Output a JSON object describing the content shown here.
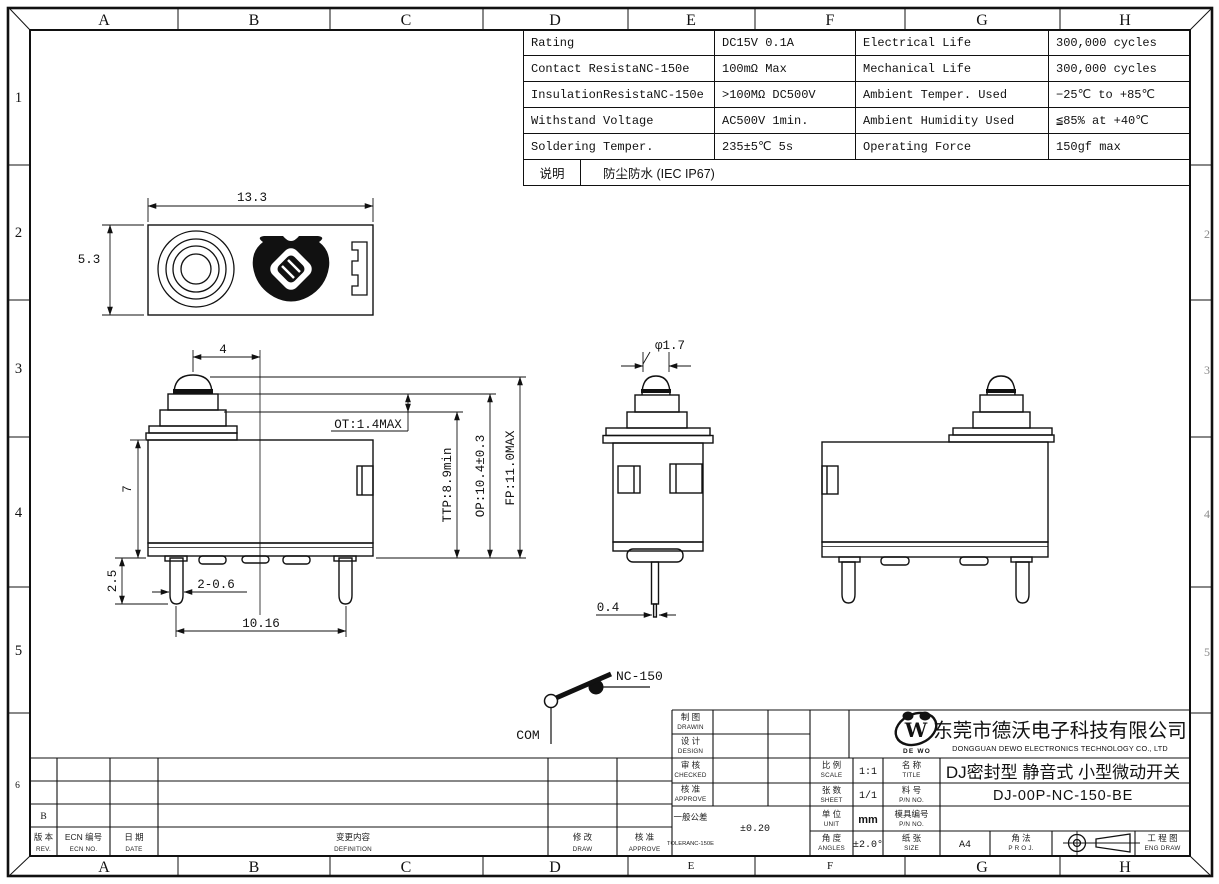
{
  "frame": {
    "cols": [
      "A",
      "B",
      "C",
      "D",
      "E",
      "F",
      "G",
      "H"
    ],
    "rows": [
      "1",
      "2",
      "3",
      "4",
      "5",
      "6"
    ],
    "rows_right": [
      "2",
      "3",
      "4",
      "5"
    ]
  },
  "spec": {
    "rows": [
      [
        "Rating",
        "DC15V 0.1A",
        "Electrical Life",
        "300,000 cycles"
      ],
      [
        "Contact ResistaNC-150e",
        "100mΩ Max",
        "Mechanical Life",
        "300,000 cycles"
      ],
      [
        "InsulationResistaNC-150e",
        ">100MΩ DC500V",
        "Ambient Temper. Used",
        "−25℃ to +85℃"
      ],
      [
        "Withstand Voltage",
        "AC500V 1min.",
        "Ambient Humidity Used",
        "≦85% at +40℃"
      ],
      [
        "Soldering Temper.",
        "235±5℃ 5s",
        "Operating Force",
        "150gf max"
      ]
    ],
    "note_label": "说明",
    "note_value": "防尘防水 (IEC IP67)"
  },
  "dims": {
    "width": "13.3",
    "height": "5.3",
    "offset": "4",
    "ot": "OT:1.4MAX",
    "ttp": "TTP:8.9min",
    "op": "OP:10.4±0.3",
    "fp": "FP:11.0MAX",
    "body": "7",
    "pin_len": "2.5",
    "pin_w": "2-0.6",
    "pitch": "10.16",
    "dia": "φ1.7",
    "tip": "0.4"
  },
  "circuit": {
    "nc": "NC-150",
    "com": "COM"
  },
  "revisions": {
    "rev_zh": "版 本",
    "rev_en": "REV.",
    "ecn_zh": "ECN 编号",
    "ecn_en": "ECN NO.",
    "date_zh": "日 期",
    "date_en": "DATE",
    "def_zh": "变更内容",
    "def_en": "DEFINITION",
    "draw_zh": "修 改",
    "draw_en": "DRAW",
    "appr_zh": "核 准",
    "appr_en": "APPROVE",
    "entry_rev": "B"
  },
  "tb": {
    "drawin_zh": "制 图",
    "drawin_en": "DRAWIN",
    "design_zh": "设 计",
    "design_en": "DESIGN",
    "checked_zh": "审 核",
    "checked_en": "CHECKED",
    "approve_zh": "核 准",
    "approve_en": "APPROVE",
    "tol_zh": "一般公差",
    "tol_en": "TOLERANC-150E",
    "tol_val": "±0.20",
    "scale_zh": "比 例",
    "scale_en": "SCALE",
    "scale_val": "1:1",
    "sheet_zh": "张 数",
    "sheet_en": "SHEET",
    "sheet_val": "1/1",
    "unit_zh": "单 位",
    "unit_en": "UNIT",
    "unit_val": "mm",
    "angles_zh": "角 度",
    "angles_en": "ANGLES",
    "angles_val": "±2.0°",
    "title_zh": "名 称",
    "title_en": "TITLE",
    "title_val": "DJ密封型 静音式 小型微动开关",
    "pn_zh": "料 号",
    "pn_en": "P/N NO.",
    "pn_val": "DJ-00P-NC-150-BE",
    "mold_zh": "模具编号",
    "mold_en": "P/N NO.",
    "size_zh": "纸 张",
    "size_en": "SIZE",
    "size_val": "A4",
    "proj_zh": "角 法",
    "proj_en": "P R O J.",
    "eng_zh": "工 程 图",
    "eng_en": "ENG DRAW",
    "company_zh": "东莞市德沃电子科技有限公司",
    "company_en": "DONGGUAN DEWO ELECTRONICS TECHNOLOGY CO., LTD",
    "logo_w": "W",
    "logo_text": "DE WO"
  }
}
